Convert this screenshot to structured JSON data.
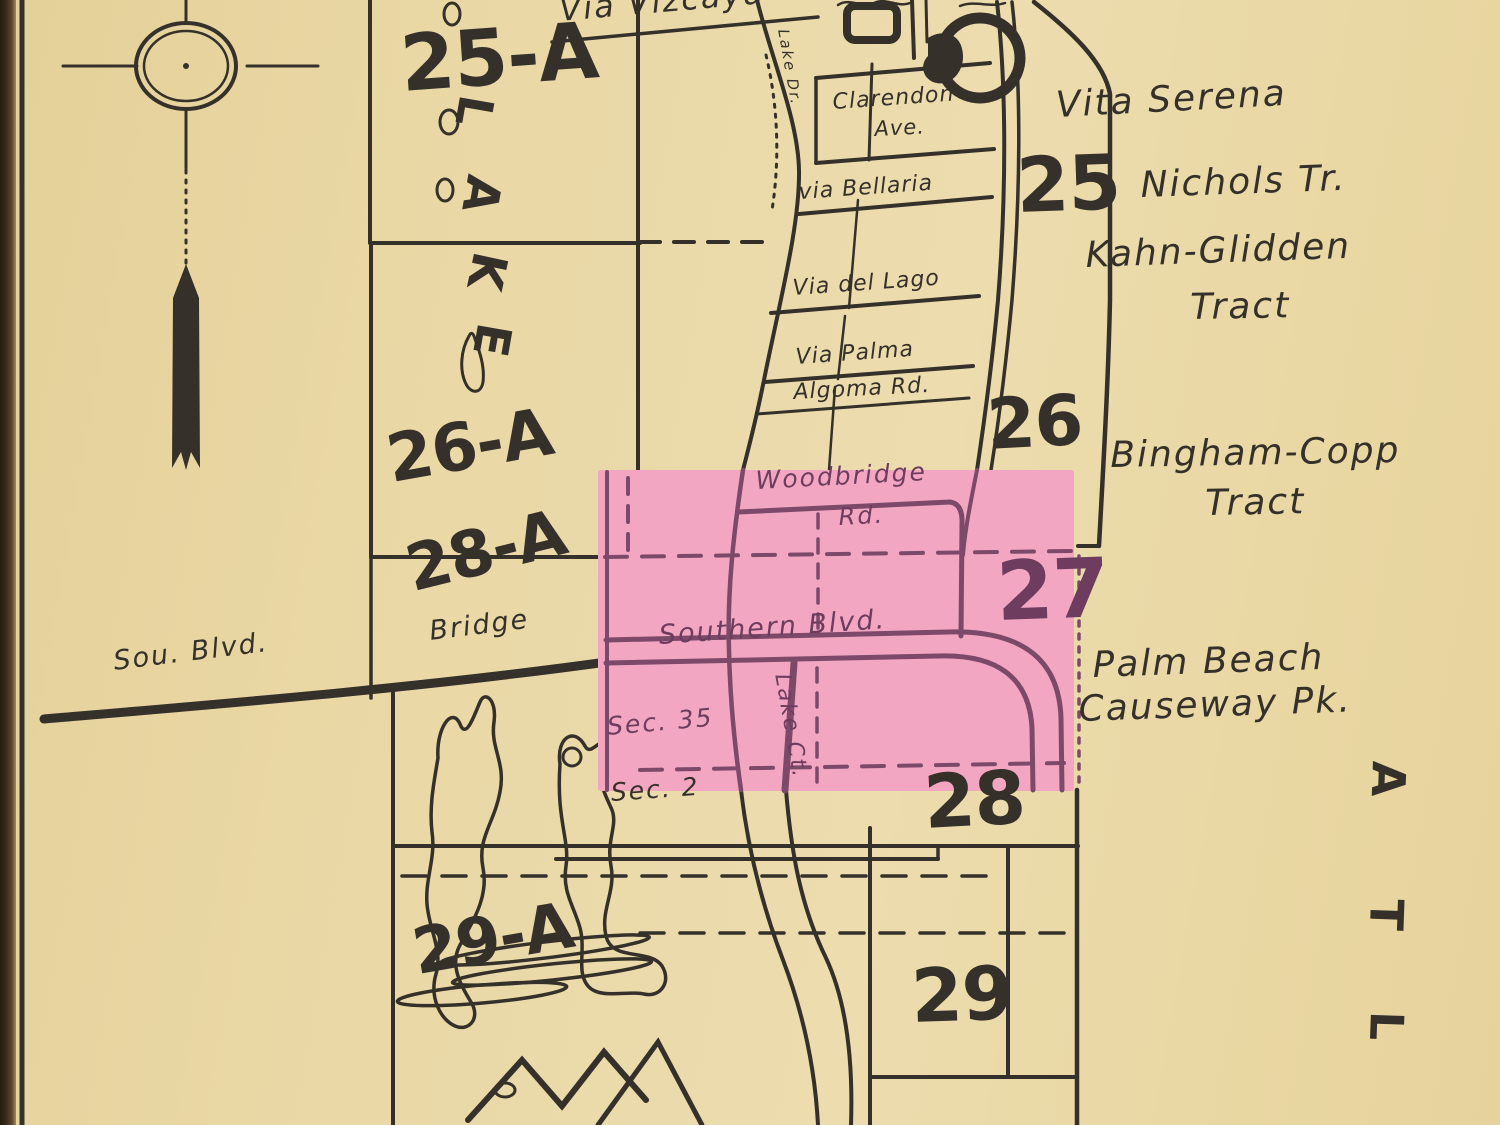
{
  "map": {
    "streets": {
      "via_vizcaya": "Via Vizcaya",
      "clarendon": "Clarendon",
      "clarendon_ave": "Ave.",
      "via_bellaria": "via Bellaria",
      "via_del_lago": "Via del Lago",
      "via_palma": "Via  Palma",
      "algoma_rd": "Algoma Rd.",
      "woodbridge": "Woodbridge",
      "woodbridge_rd": "Rd.",
      "southern_blvd": "Southern Blvd.",
      "lake_ct": "Lake Ct.",
      "lake_dr": "Lake Dr.",
      "sou_blvd": "Sou.  Blvd.",
      "bridge": "Bridge"
    },
    "tracts": {
      "vita_serena": "Vita Serena",
      "nichols": "Nichols Tr.",
      "kahn_glidden": "Kahn-Glidden",
      "kahn_glidden_tract": "Tract",
      "bingham_copp": "Bingham-Copp",
      "bingham_tract": "Tract",
      "palm_beach": "Palm Beach",
      "causeway": "Causeway Pk."
    },
    "sections": {
      "sec35": "Sec. 35",
      "sec2": "Sec. 2"
    },
    "sheets": {
      "s25a": "25-A",
      "s26a": "26-A",
      "s28a": "28-A",
      "s29a": "29-A",
      "s25": "25",
      "s26": "26",
      "s27": "27",
      "s28": "28",
      "s29": "29"
    },
    "water": {
      "lake": [
        "L",
        "A",
        "K",
        "E"
      ],
      "atlantic": [
        "A",
        "T",
        "L"
      ]
    },
    "highlight": {
      "sheet": "27"
    },
    "colors": {
      "paper": "#e9d7a4",
      "ink": "#35302a",
      "highlight_pink": "#f3a6c1",
      "highlight_line": "#7c4a68"
    }
  }
}
